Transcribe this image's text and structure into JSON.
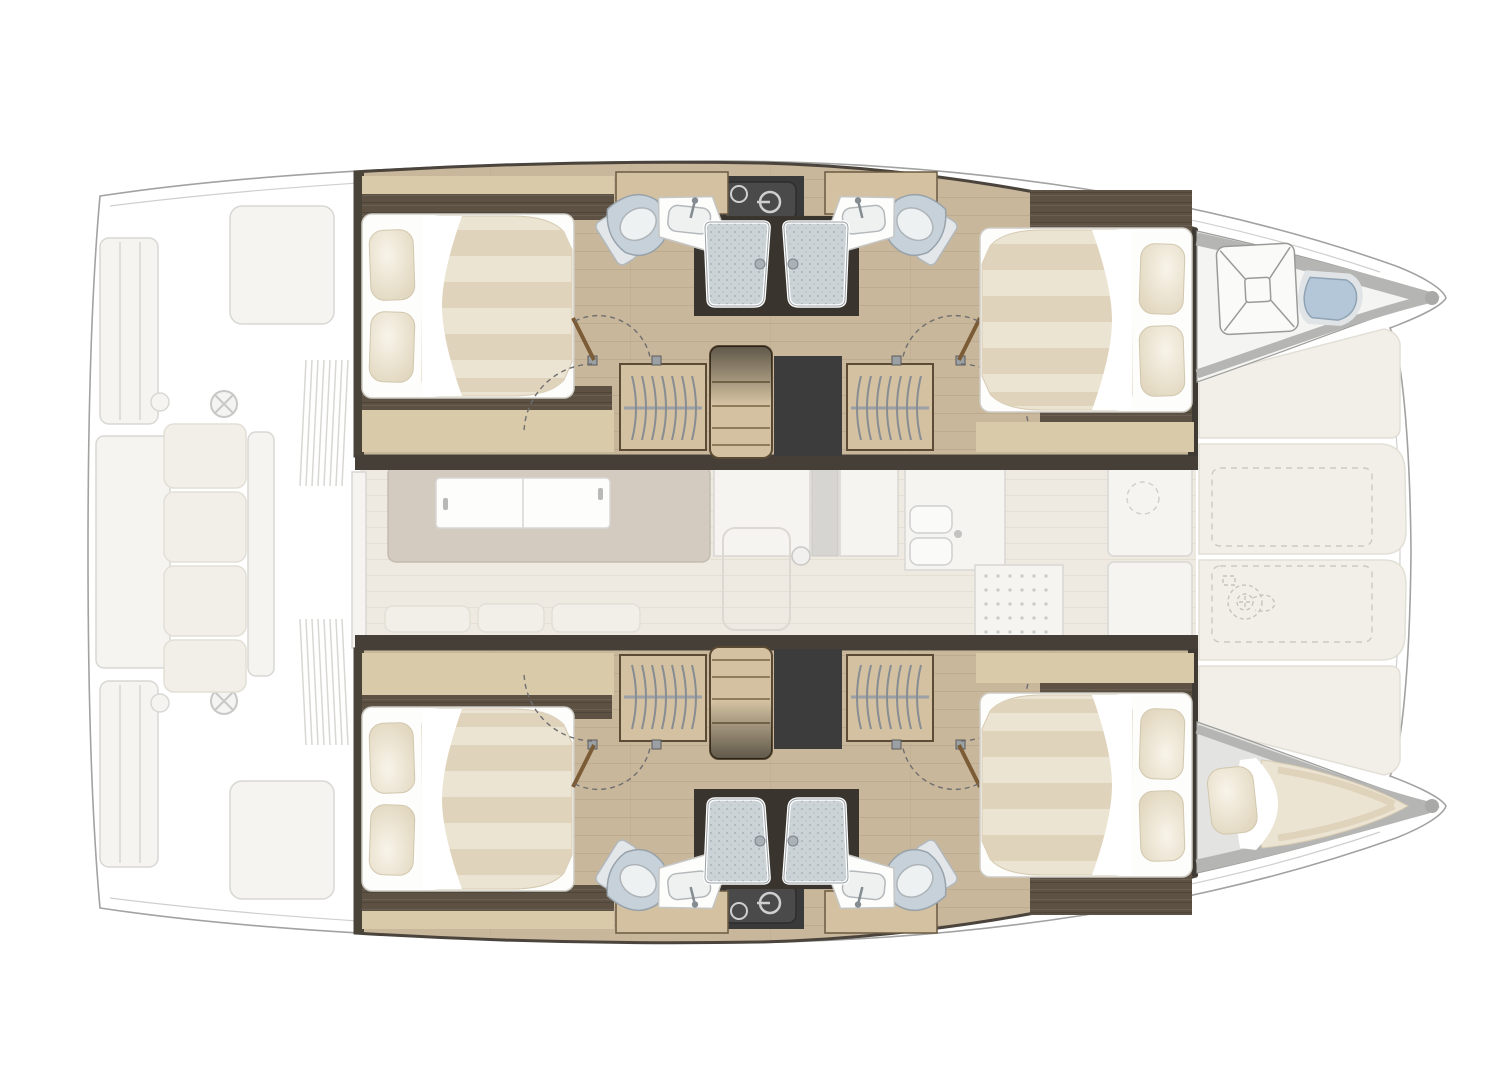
{
  "title": "Catamaran interior layout plan — 4 guest cabins, 4 bathrooms (top view, bow to the right)",
  "view": {
    "type": "floor-plan",
    "orientation": {
      "bow": "right",
      "stern": "left",
      "port_hull": "top",
      "starboard_hull": "bottom"
    },
    "highlighted": "hull accommodations (full colour)",
    "ghosted": "exterior decks, aft cockpit, saloon, galley and foredeck lounge (faded grey)"
  },
  "areas": {
    "aft_cockpit": {
      "name": "Aft cockpit (faded)",
      "items": [
        "transom steps",
        "swim platform",
        "storage hatches",
        "helm wheel",
        "bench seating with cushions",
        "louvered vents"
      ]
    },
    "saloon": {
      "name": "Saloon (faded)",
      "items": [
        "sideboard with white sliding doors",
        "sofa bench cushions",
        "floor hatch with knob",
        "forward door unit"
      ]
    },
    "galley": {
      "name": "Galley (faded)",
      "items": [
        "double sink with faucet",
        "stove top",
        "refrigerator with round hatch",
        "counter units"
      ]
    },
    "foredeck_lounge": {
      "name": "Forward cockpit / sunpad (faded)",
      "items": [
        "four lounge cushions",
        "two deck lockers (dashed)",
        "windlass winch (dashed)"
      ]
    },
    "port_hull": {
      "name": "Port hull (top)",
      "aft_cabin": {
        "berth": "double bed",
        "pillows": 2,
        "features": [
          "striped mattress",
          "white sheet fold",
          "walnut head/foot boards",
          "hanging locker"
        ]
      },
      "aft_bathroom": {
        "fixtures": [
          "toilet",
          "washbasin with faucet",
          "shower cabin with speckled tray"
        ]
      },
      "forward_bathroom": {
        "fixtures": [
          "toilet",
          "washbasin with faucet",
          "shower cabin with speckled tray"
        ]
      },
      "forward_cabin": {
        "berth": "double bed",
        "pillows": 2
      },
      "middle": [
        "companionway stairs",
        "two hanging wardrobes",
        "technical void",
        "dark appliance unit"
      ],
      "forepeak": {
        "use": "bow head",
        "fixtures": [
          "square shower tray with X pattern",
          "sea toilet (blue)"
        ]
      }
    },
    "starboard_hull": {
      "name": "Starboard hull (bottom, mirror of port hull)",
      "aft_cabin": {
        "berth": "double bed",
        "pillows": 2
      },
      "aft_bathroom": {
        "fixtures": [
          "toilet",
          "washbasin",
          "shower cabin"
        ]
      },
      "forward_bathroom": {
        "fixtures": [
          "toilet",
          "washbasin",
          "shower cabin"
        ]
      },
      "forward_cabin": {
        "berth": "double bed",
        "pillows": 2
      },
      "middle": [
        "companionway stairs",
        "two hanging wardrobes",
        "technical void",
        "dark appliance unit"
      ],
      "forepeak": {
        "use": "skipper berth",
        "fixtures": [
          "wedge mattress",
          "single pillow"
        ]
      }
    }
  },
  "counts": {
    "double_beds": 4,
    "bathrooms": 4,
    "showers": 5,
    "toilets": 5,
    "wardrobes": 4,
    "companionway_stairs": 2
  },
  "colors": {
    "page_bg": "#ffffff",
    "outline": "#a2a2a0",
    "outline_faint": "#cfcfcd",
    "deck_fill": "#fcfcfa",
    "faded_item": "#f5f4f1",
    "faded_stroke": "#d8d7d3",
    "cushion_faded": "#f2efe8",
    "floor_wood": "#c9b79c",
    "wood_light": "#d3c1a1",
    "wood_pale": "#d9cbaa",
    "walnut": "#5c5143",
    "trim_dark": "#453f37",
    "door_brown": "#7b5c36",
    "void_dark": "#3c3c3c",
    "appliance_dark": "#4a4a4a",
    "mattress": "#ece4d3",
    "mattress_stripe": "#e0d3bc",
    "sheet_white": "#fdfdfb",
    "pillow": "#eadfc9",
    "toilet_white": "#eef1f2",
    "toilet_lid": "#c6d1da",
    "toilet_blue": "#b4c7d8",
    "sink_white": "#fdfdfc",
    "basin_gray": "#eff1f1",
    "shower_tray": "#ccd3d7",
    "shower_frame": "#39352e",
    "metal_gray": "#8f979e",
    "speckle_gray": "#b5b5b3",
    "berth_gray": "#e3e3e1",
    "saloon_floor": "#efeae1"
  }
}
